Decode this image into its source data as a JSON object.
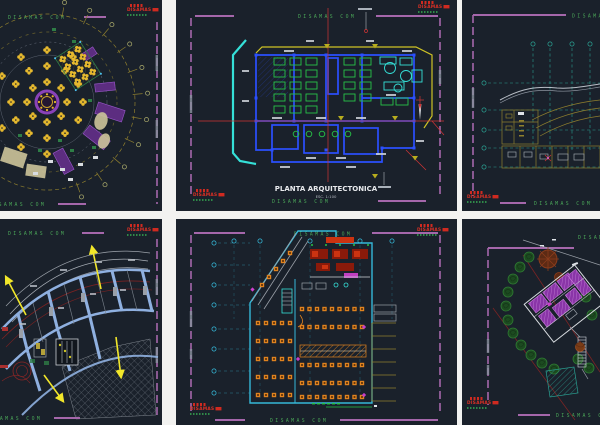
{
  "watermark": {
    "text": "DISAMAS COM"
  },
  "logo": {
    "text": "DISAMAS"
  },
  "sheet_tm": {
    "title": "PLANTA ARQUITECTONICA",
    "scale": "ESC. 1:100"
  },
  "colors": {
    "panel_background": "#1a212b",
    "gutter": "#f2f2f0",
    "border_magenta": "#a567ab",
    "watermark_green": "#4aa558",
    "logo_red": "#d02a20",
    "cad_yellow": "#e6b92e",
    "cad_olive": "#8f7f2e",
    "cad_blue": "#2b50ff",
    "cad_cyan": "#35e0d8",
    "cad_green": "#27c447",
    "cad_red": "#d03434",
    "cad_orange": "#e0831f",
    "cad_periwinkle": "#8fb0e0",
    "cad_teal": "#2a9d8f",
    "cad_purple": "#5c2d80"
  }
}
